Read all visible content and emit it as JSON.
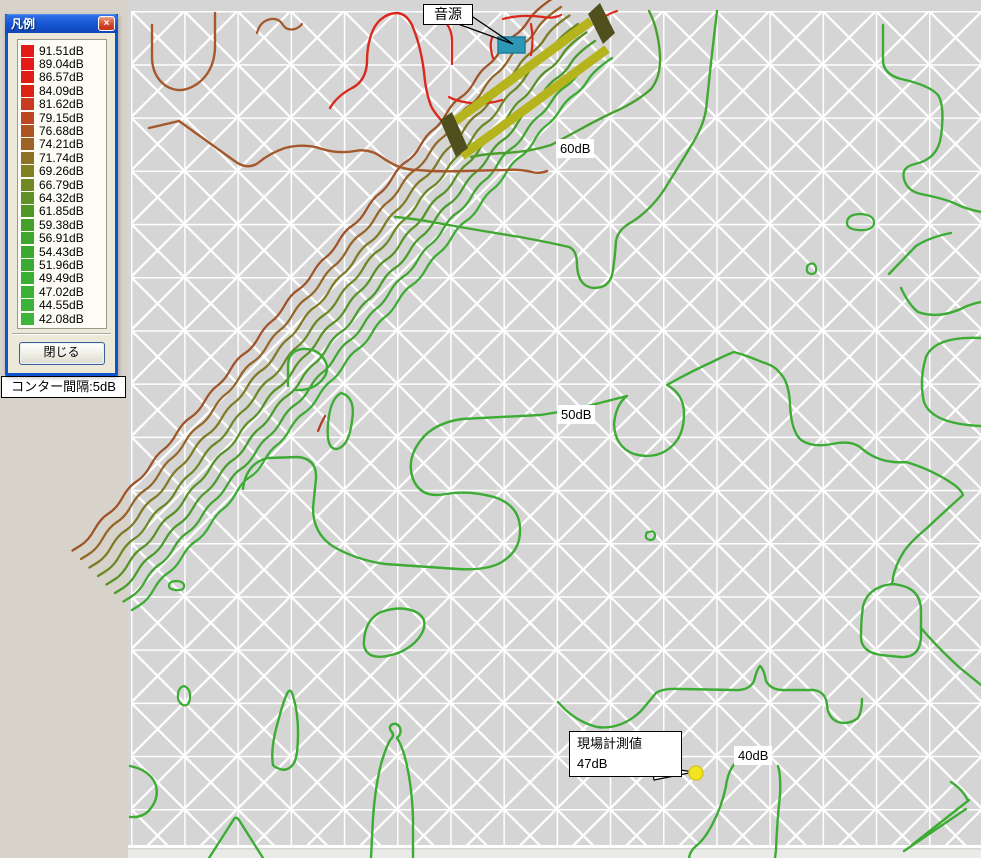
{
  "legend": {
    "title": "凡例",
    "close_icon": "×",
    "close_button": "閉じる",
    "items": [
      {
        "color": "#E31A17",
        "label": "91.51dB"
      },
      {
        "color": "#E31A17",
        "label": "89.04dB"
      },
      {
        "color": "#DF1F16",
        "label": "86.57dB"
      },
      {
        "color": "#DB2415",
        "label": "84.09dB"
      },
      {
        "color": "#C93A20",
        "label": "81.62dB"
      },
      {
        "color": "#BC4522",
        "label": "79.15dB"
      },
      {
        "color": "#AC5424",
        "label": "76.68dB"
      },
      {
        "color": "#9D6226",
        "label": "74.21dB"
      },
      {
        "color": "#8D7126",
        "label": "71.74dB"
      },
      {
        "color": "#818024",
        "label": "69.26dB"
      },
      {
        "color": "#6F8A25",
        "label": "66.79dB"
      },
      {
        "color": "#5F9126",
        "label": "64.32dB"
      },
      {
        "color": "#4F9828",
        "label": "61.85dB"
      },
      {
        "color": "#45A02B",
        "label": "59.38dB"
      },
      {
        "color": "#3EA52E",
        "label": "56.91dB"
      },
      {
        "color": "#3BA930",
        "label": "54.43dB"
      },
      {
        "color": "#39AB32",
        "label": "51.96dB"
      },
      {
        "color": "#3AAF34",
        "label": "49.49dB"
      },
      {
        "color": "#3BB136",
        "label": "47.02dB"
      },
      {
        "color": "#3CB338",
        "label": "44.55dB"
      },
      {
        "color": "#3DB43A",
        "label": "42.08dB"
      }
    ]
  },
  "interval_label": "コンター間隔:5dB",
  "map": {
    "annotations": {
      "source_label": "音源",
      "label_60": "60dB",
      "label_50": "50dB",
      "label_40": "40dB",
      "measurement_line1": "現場計測値",
      "measurement_line2": "47dB"
    },
    "colors": {
      "page_bg": "#D7D3CA",
      "map_bg": "#D5D5D5",
      "grid": "#FFFFFF",
      "bottom_strip": "#EAEAE8",
      "barrier": "#B5B41C",
      "barrier_cap": "#50501E",
      "source_fill": "#2E97B5",
      "source_stroke": "#1F7E9B",
      "marker_fill": "#F2E41F",
      "marker_stroke": "#D8C81A"
    },
    "band": {
      "base": [
        [
          612,
          58
        ],
        [
          594,
          70
        ],
        [
          582,
          90
        ],
        [
          566,
          100
        ],
        [
          554,
          120
        ],
        [
          540,
          130
        ],
        [
          528,
          152
        ],
        [
          512,
          162
        ],
        [
          500,
          184
        ],
        [
          486,
          194
        ],
        [
          474,
          216
        ],
        [
          458,
          226
        ],
        [
          446,
          248
        ],
        [
          432,
          258
        ],
        [
          420,
          280
        ],
        [
          404,
          290
        ],
        [
          392,
          312
        ],
        [
          378,
          322
        ],
        [
          366,
          344
        ],
        [
          350,
          354
        ],
        [
          338,
          376
        ],
        [
          324,
          386
        ],
        [
          312,
          408
        ],
        [
          296,
          418
        ],
        [
          284,
          440
        ],
        [
          270,
          450
        ],
        [
          258,
          472
        ],
        [
          242,
          482
        ],
        [
          230,
          504
        ],
        [
          216,
          514
        ],
        [
          204,
          536
        ],
        [
          188,
          546
        ],
        [
          176,
          568
        ],
        [
          160,
          578
        ],
        [
          148,
          600
        ],
        [
          132,
          610
        ]
      ],
      "lines": [
        {
          "offset": 59.5,
          "color": "#9E5428"
        },
        {
          "offset": 51,
          "color": "#956628"
        },
        {
          "offset": 42.5,
          "color": "#7F7A25"
        },
        {
          "offset": 34,
          "color": "#6C8826"
        },
        {
          "offset": 25.5,
          "color": "#579227"
        },
        {
          "offset": 17,
          "color": "#499C2C"
        },
        {
          "offset": 8.5,
          "color": "#41A531"
        },
        {
          "offset": 0,
          "color": "#3CAC35"
        }
      ]
    },
    "contours": [
      {
        "color": "#DC281C",
        "w": 2.4,
        "d": "M330,108 Q337,96 352,88 Q366,81 367,62 Q367,42 374,28 Q382,14 396,13 Q408,13 414,30 Q421,48 424,72 Q426,95 432,108 Q437,116 442,121"
      },
      {
        "color": "#DC281C",
        "w": 2.2,
        "d": "M452,64 L452,41 Q452,30 446,23"
      },
      {
        "color": "#DC281C",
        "w": 2.2,
        "d": "M502,100 Q483,106 464,102 Q454,100 449,97"
      },
      {
        "color": "#DC281C",
        "w": 2.2,
        "d": "M503,19 Q521,14 543,17 Q553,19 561,15"
      },
      {
        "color": "#DC281C",
        "w": 2.2,
        "d": "M531,55 Q534,40 531,24"
      },
      {
        "color": "#DC281C",
        "w": 2.2,
        "d": "M493,58 Q489,45 492,38"
      },
      {
        "color": "#DC281C",
        "w": 2.2,
        "d": "M597,22 Q607,14 617,11"
      },
      {
        "color": "#B03A1E",
        "w": 2.2,
        "d": "M318,431 Q321,423 325,416"
      },
      {
        "color": "#A4582B",
        "w": 2.4,
        "d": "M152,25 L152,57 Q152,76 166,86 Q181,95 197,84 Q214,72 215,48 L215,13"
      },
      {
        "color": "#A4582B",
        "w": 2.2,
        "d": "M257,33 Q260,21 271,19 Q279,18 283,25 Q287,31 295,29 Q300,27 302,24"
      },
      {
        "color": "#A4582B",
        "w": 2.4,
        "d": "M149,128 L179,121 L236,162 Q248,170 258,163 Q270,153 285,148 Q305,143 322,149 Q338,154 355,151 Q370,148 383,158 Q398,169 415,170 Q440,172 465,171 L505,170 Q520,169 532,172 Q540,174 547,171"
      },
      {
        "color": "#3CAC34",
        "w": 2.4,
        "d": "M243,489 Q246,463 268,458 L298,457 Q317,459 316,478 L313,508 Q313,534 334,547 Q357,560 385,564 L458,569 Q492,571 506,559 Q521,548 520,528 Q519,505 494,497 Q468,490 446,494 Q421,499 413,479 Q406,459 421,440 Q434,423 462,419 L540,415 Q560,412 576,409 Q600,403 627,396 Q616,404 614,424 Q615,447 634,454 Q656,460 671,447 Q684,436 684,414 Q684,394 667,385 Q688,373 712,362 Q726,355 734,352 Q748,356 762,362 Q775,366 779,372 Q789,381 790,404 Q791,431 801,440 Q813,448 832,444 Q850,440 860,447 Q872,458 887,461 Q897,463 906,462 Q930,469 950,482 Q961,489 963,495 Q944,512 927,528 Q909,543 903,553 Q895,566 893,578 L892,584"
      },
      {
        "color": "#3CAC34",
        "w": 2.4,
        "d": "M892,584 Q868,587 863,606 Q861,620 861,637 Q861,652 881,655 L901,657 Q920,658 921,637 L921,611 Q921,589 899,585 Q895,584 892,584"
      },
      {
        "color": "#3CAC34",
        "w": 2.4,
        "d": "M921,628 Q938,648 960,668 Q970,676 981,685"
      },
      {
        "color": "#3CAC34",
        "w": 2.4,
        "d": "M558,702 Q574,721 597,727 Q621,730 641,711 Q652,698 656,693 Q663,688 681,689 L734,690 Q749,691 754,681 Q757,669 760,666 Q764,669 766,681 Q771,690 783,690 L814,690 Q826,692 827,705 Q828,718 838,722 Q849,725 858,718 Q862,711 862,699"
      },
      {
        "color": "#3CAC34",
        "w": 2.4,
        "d": "M288,386 L288,366 Q288,351 302,349 Q317,348 324,359 Q331,370 322,380 Q312,391 296,390"
      },
      {
        "color": "#3CAC34",
        "w": 2.4,
        "d": "M341,393 Q356,397 352,421 Q349,446 337,449 Q326,450 328,424 Q330,399 341,393"
      },
      {
        "color": "#3CAC34",
        "w": 2.2,
        "d": "M184,686 Q191,689 190,698 Q189,707 183,705 Q177,702 178,694 Q179,687 184,686"
      },
      {
        "color": "#3CAC34",
        "w": 2.2,
        "d": "M169,586 Q169,581 177,581 Q185,582 184,587 Q183,591 175,590 Q169,589 169,586"
      },
      {
        "color": "#3CAC34",
        "w": 2.4,
        "d": "M364,641 Q365,620 381,612 Q401,605 416,612 Q429,619 422,633 Q415,646 398,653 Q378,660 369,654 Q363,649 364,641"
      },
      {
        "color": "#3CAC34",
        "w": 2.4,
        "d": "M273,765 Q270,748 279,718 Q284,699 288,692 Q291,688 293,696 Q298,712 298,732 Q298,756 294,763 Q288,772 280,769 Q274,767 273,765"
      },
      {
        "color": "#3CAC34",
        "w": 2.4,
        "d": "M130,766 Q149,770 155,783 Q160,796 151,808 Q144,818 130,817"
      },
      {
        "color": "#3CAC34",
        "w": 2.4,
        "d": "M209,858 L234,819 Q236,816 239,820 L263,858"
      },
      {
        "color": "#3CAC34",
        "w": 2.4,
        "d": "M371,858 L373,818 Q375,788 381,764 Q387,744 391,739 Q395,735 391,731 Q388,726 393,724 Q398,723 400,728 Q402,733 397,738 Q403,747 407,766 Q412,789 413,818 L413,858"
      },
      {
        "color": "#3CAC34",
        "w": 2.4,
        "d": "M737,761 Q728,770 726,786 Q722,806 713,823 Q705,839 696,846 Q690,851 689,858"
      },
      {
        "color": "#3CAC34",
        "w": 2.4,
        "d": "M778,766 Q781,775 780,795 Q777,822 776,850 L775,858"
      },
      {
        "color": "#3CAC34",
        "w": 2.4,
        "d": "M912,845 L969,800"
      },
      {
        "color": "#3CAC34",
        "w": 2.4,
        "d": "M904,851 L966,809"
      },
      {
        "color": "#3CAC34",
        "w": 2.4,
        "d": "M951,782 Q963,790 967,799"
      },
      {
        "color": "#48A12D",
        "w": 2.4,
        "d": "M649,11 Q658,28 660,55 Q661,77 651,89 Q638,101 614,112 Q593,122 579,130 Q564,138 551,145 Q529,152 504,153 Q484,154 471,157"
      },
      {
        "color": "#41A831",
        "w": 2.4,
        "d": "M717,11 Q711,60 706,110 Q703,126 694,141 Q679,166 664,190 Q649,212 630,223 Q618,230 616,241 Q615,256 613,270 Q611,288 594,288 Q578,287 577,265 Q577,250 569,247 Q552,243 520,237 Q470,229 432,222 Q408,218 395,217"
      },
      {
        "color": "#3CAC34",
        "w": 2.4,
        "d": "M883,25 L883,60 Q883,74 901,79 Q929,85 938,95 Q945,106 941,136 Q938,159 915,164 Q901,167 904,179 Q907,191 921,194 Q946,199 956,204 Q966,209 981,212"
      },
      {
        "color": "#3CAC34",
        "w": 2.4,
        "d": "M901,288 Q909,305 918,312 Q940,320 967,306 Q975,303 981,302"
      },
      {
        "color": "#3CAC34",
        "w": 2.4,
        "d": "M981,338 Q935,336 926,357 Q919,380 924,402 Q932,424 981,426"
      },
      {
        "color": "#3CAC34",
        "w": 2.2,
        "d": "M847,223 Q847,214 861,214 Q875,215 874,224 Q872,231 858,230 Q847,229 847,223"
      },
      {
        "color": "#3CAC34",
        "w": 2.2,
        "d": "M810,264 Q815,262 816,268 Q817,274 811,274 Q806,273 807,268 Q807,265 810,264"
      },
      {
        "color": "#3CAC34",
        "w": 2.4,
        "d": "M889,274 L916,246 Q930,237 951,233"
      },
      {
        "color": "#3CAC34",
        "w": 2.2,
        "d": "M649,532 Q654,530 655,535 Q655,540 650,540 Q645,539 646,535 Q646,532 649,532"
      }
    ]
  }
}
